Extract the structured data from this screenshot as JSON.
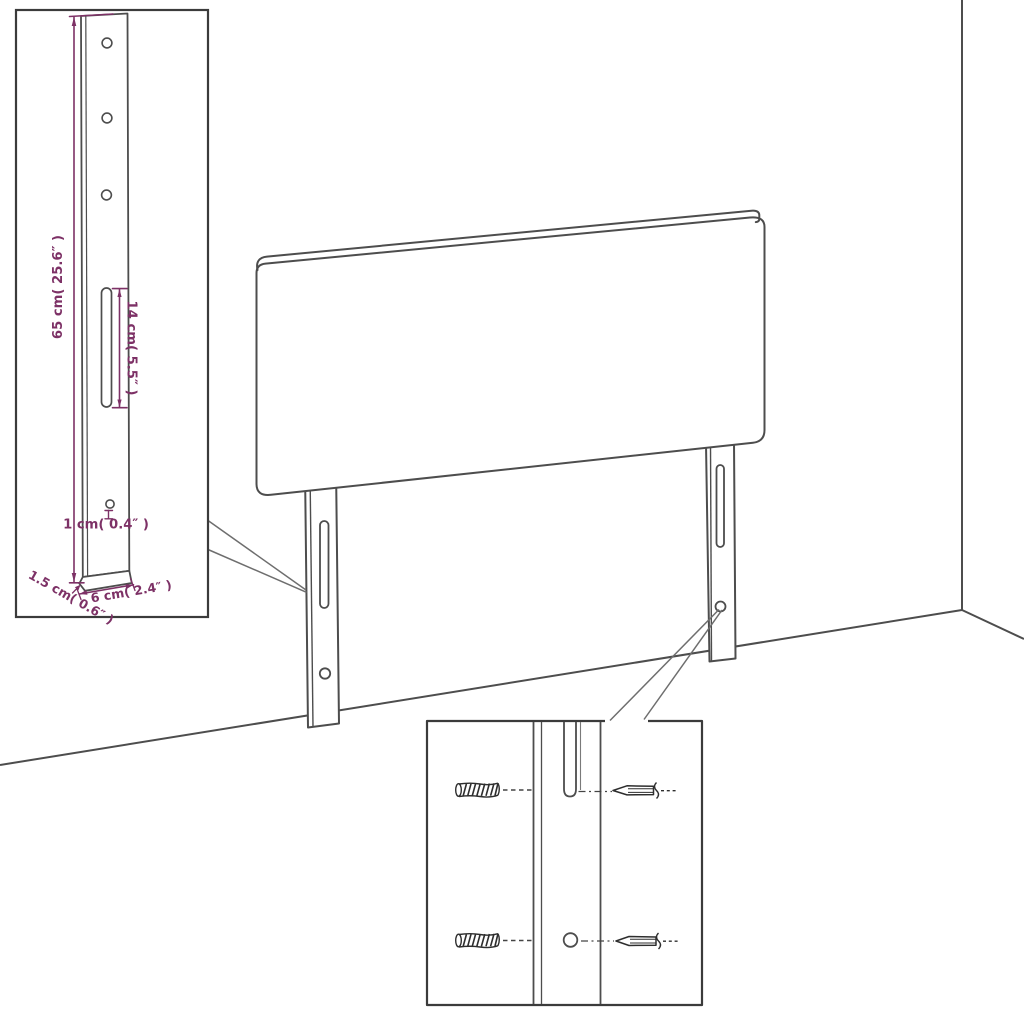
{
  "figure": {
    "type": "product dimension diagram",
    "subject": "upholstered headboard with two slotted mounting legs, wall-corner backdrop, bracket detail inset and wall-plug/screw hardware inset",
    "background_color": "#ffffff",
    "colors": {
      "outline": "#4d4d4d",
      "inset_border": "#3b3b3b",
      "dimension": "#7d3166",
      "hardware": "#2e2e2e",
      "callout": "#6e6e6e"
    },
    "labels": {
      "leg_height": "65 cm( 25.6″ )",
      "slot_length": "14 cm( 5.5″ )",
      "hole_diameter": "1 cm( 0.4″ )",
      "leg_thickness": "1.5 cm( 0.6″ )",
      "leg_width": "6 cm( 2.4″ )"
    }
  }
}
